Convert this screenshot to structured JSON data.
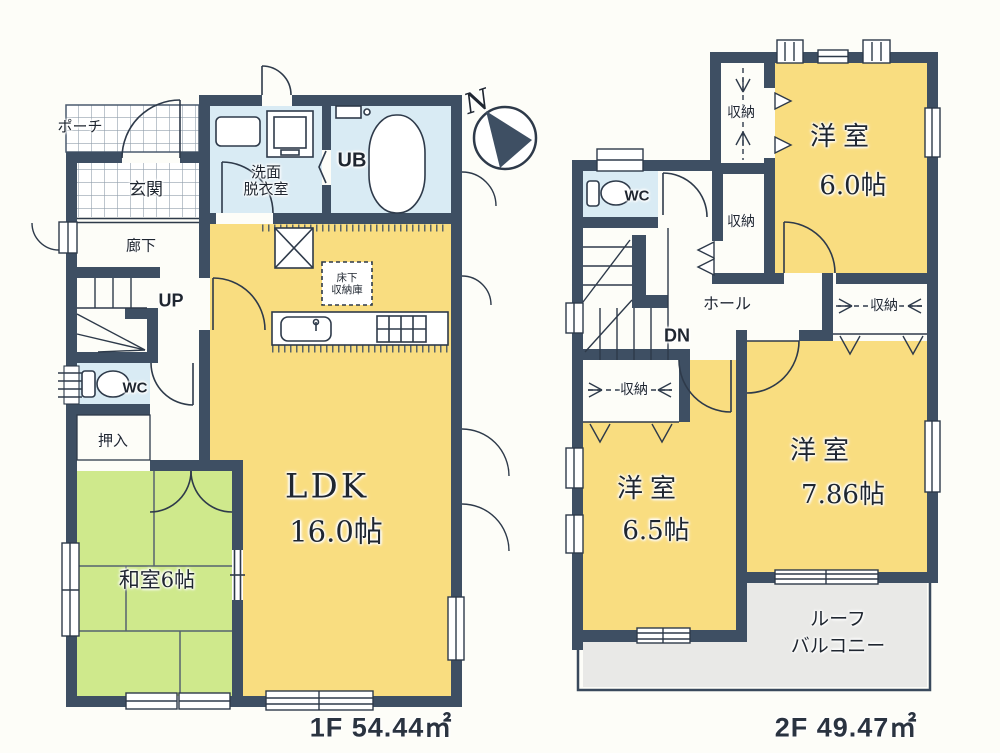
{
  "compass": {
    "north_label": "N"
  },
  "floor1": {
    "area_label": "1F 54.44㎡",
    "rooms": {
      "porch": "ポーチ",
      "entrance": "玄関",
      "corridor": "廊下",
      "stairs": "UP",
      "toilet": "WC",
      "closet": "押入",
      "japanese_room": "和室6帖",
      "washroom_line1": "洗面",
      "washroom_line2": "脱衣室",
      "unit_bath": "UB",
      "underfloor_storage_line1": "床下",
      "underfloor_storage_line2": "収納庫",
      "ldk_name": "LDK",
      "ldk_size": "16.0帖"
    }
  },
  "floor2": {
    "area_label": "2F 49.47㎡",
    "rooms": {
      "storage_north_upper": "収納",
      "storage_north_lower": "収納",
      "storage_bedroom2": "収納",
      "storage_bedroom3": "収納",
      "toilet": "WC",
      "hall": "ホール",
      "stairs": "DN",
      "bedroom1_name": "洋室",
      "bedroom1_size": "6.0帖",
      "bedroom2_name": "洋室",
      "bedroom2_size": "7.86帖",
      "bedroom3_name": "洋室",
      "bedroom3_size": "6.5帖",
      "roof_balcony_line1": "ルーフ",
      "roof_balcony_line2": "バルコニー"
    }
  },
  "colors": {
    "wall": "#3e4f63",
    "room_yellow": "#f9dd80",
    "room_green": "#cfe98c",
    "room_wet_blue": "#d9ebf4",
    "balcony_gray": "#e9e9e7",
    "background": "#fdfdf8"
  }
}
